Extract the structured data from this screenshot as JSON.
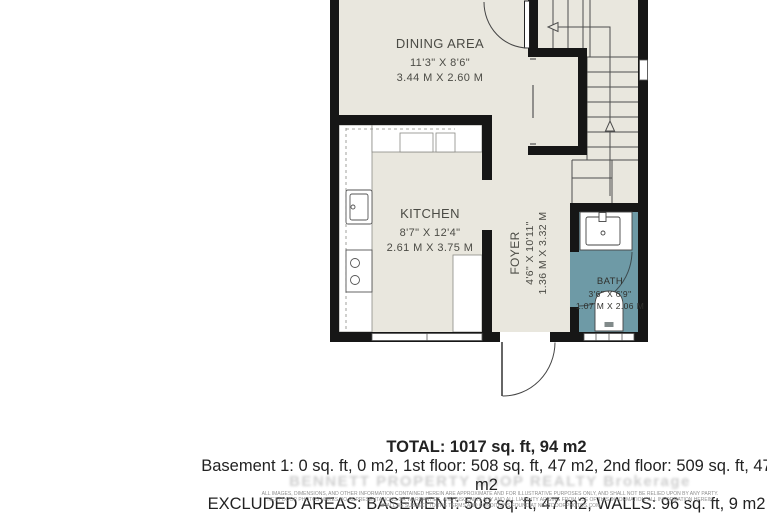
{
  "plan": {
    "rooms": [
      {
        "id": "dining",
        "name": "DINING AREA",
        "imperial": "11'3\" X 8'6\"",
        "metric": "3.44 M X 2.60 M"
      },
      {
        "id": "kitchen",
        "name": "KITCHEN",
        "imperial": "8'7\" X 12'4\"",
        "metric": "2.61 M X 3.75 M"
      },
      {
        "id": "foyer",
        "name": "FOYER",
        "imperial": "4'6\" X 10'11\"",
        "metric": "1.36 M X 3.32 M"
      },
      {
        "id": "bath",
        "name": "BATH",
        "imperial": "3'6\" X 6'9\"",
        "metric": "1.07 M X 2.06 M"
      }
    ],
    "colors": {
      "floor": "#e9e7de",
      "wall": "#161616",
      "bath_floor": "#6e9aa6",
      "fixture": "#ffffff",
      "stair_line": "#4d4d4d"
    }
  },
  "summary": {
    "total": "TOTAL: 1017 sq. ft, 94 m2",
    "floors": "Basement 1: 0 sq. ft, 0 m2, 1st floor: 508 sq. ft, 47 m2, 2nd floor: 509 sq. ft, 47 m2",
    "excluded": "EXCLUDED AREAS: BASEMENT: 508 sq. ft, 47 m2, WALLS: 96 sq. ft, 9 m2"
  },
  "watermark": {
    "text": "BENNETT PROPERTY SHOP REALTY Brokerage"
  },
  "disclaimer": {
    "line1": "ALL IMAGES, DIMENSIONS, AND OTHER INFORMATION CONTAINED HEREIN ARE APPROXIMATE AND FOR ILLUSTRATIVE PURPOSES ONLY, AND SHALL NOT BE RELIED UPON BY ANY PARTY.",
    "line2": "NEXT DOOR PHOTOS MAKES NO REPRESENTATIONS OR WARRANTIES, AND DISCLAIMS ANY AND ALL LIABILITY ARISING FROM USE OF THIS INFORMATION. ALL INFORMATION HEREIN",
    "line3": "SHALL BE SUBJECT TO THE TERMS AND CONDITIONS FOUND AT NEXTDOORPHOTOS.COM"
  }
}
